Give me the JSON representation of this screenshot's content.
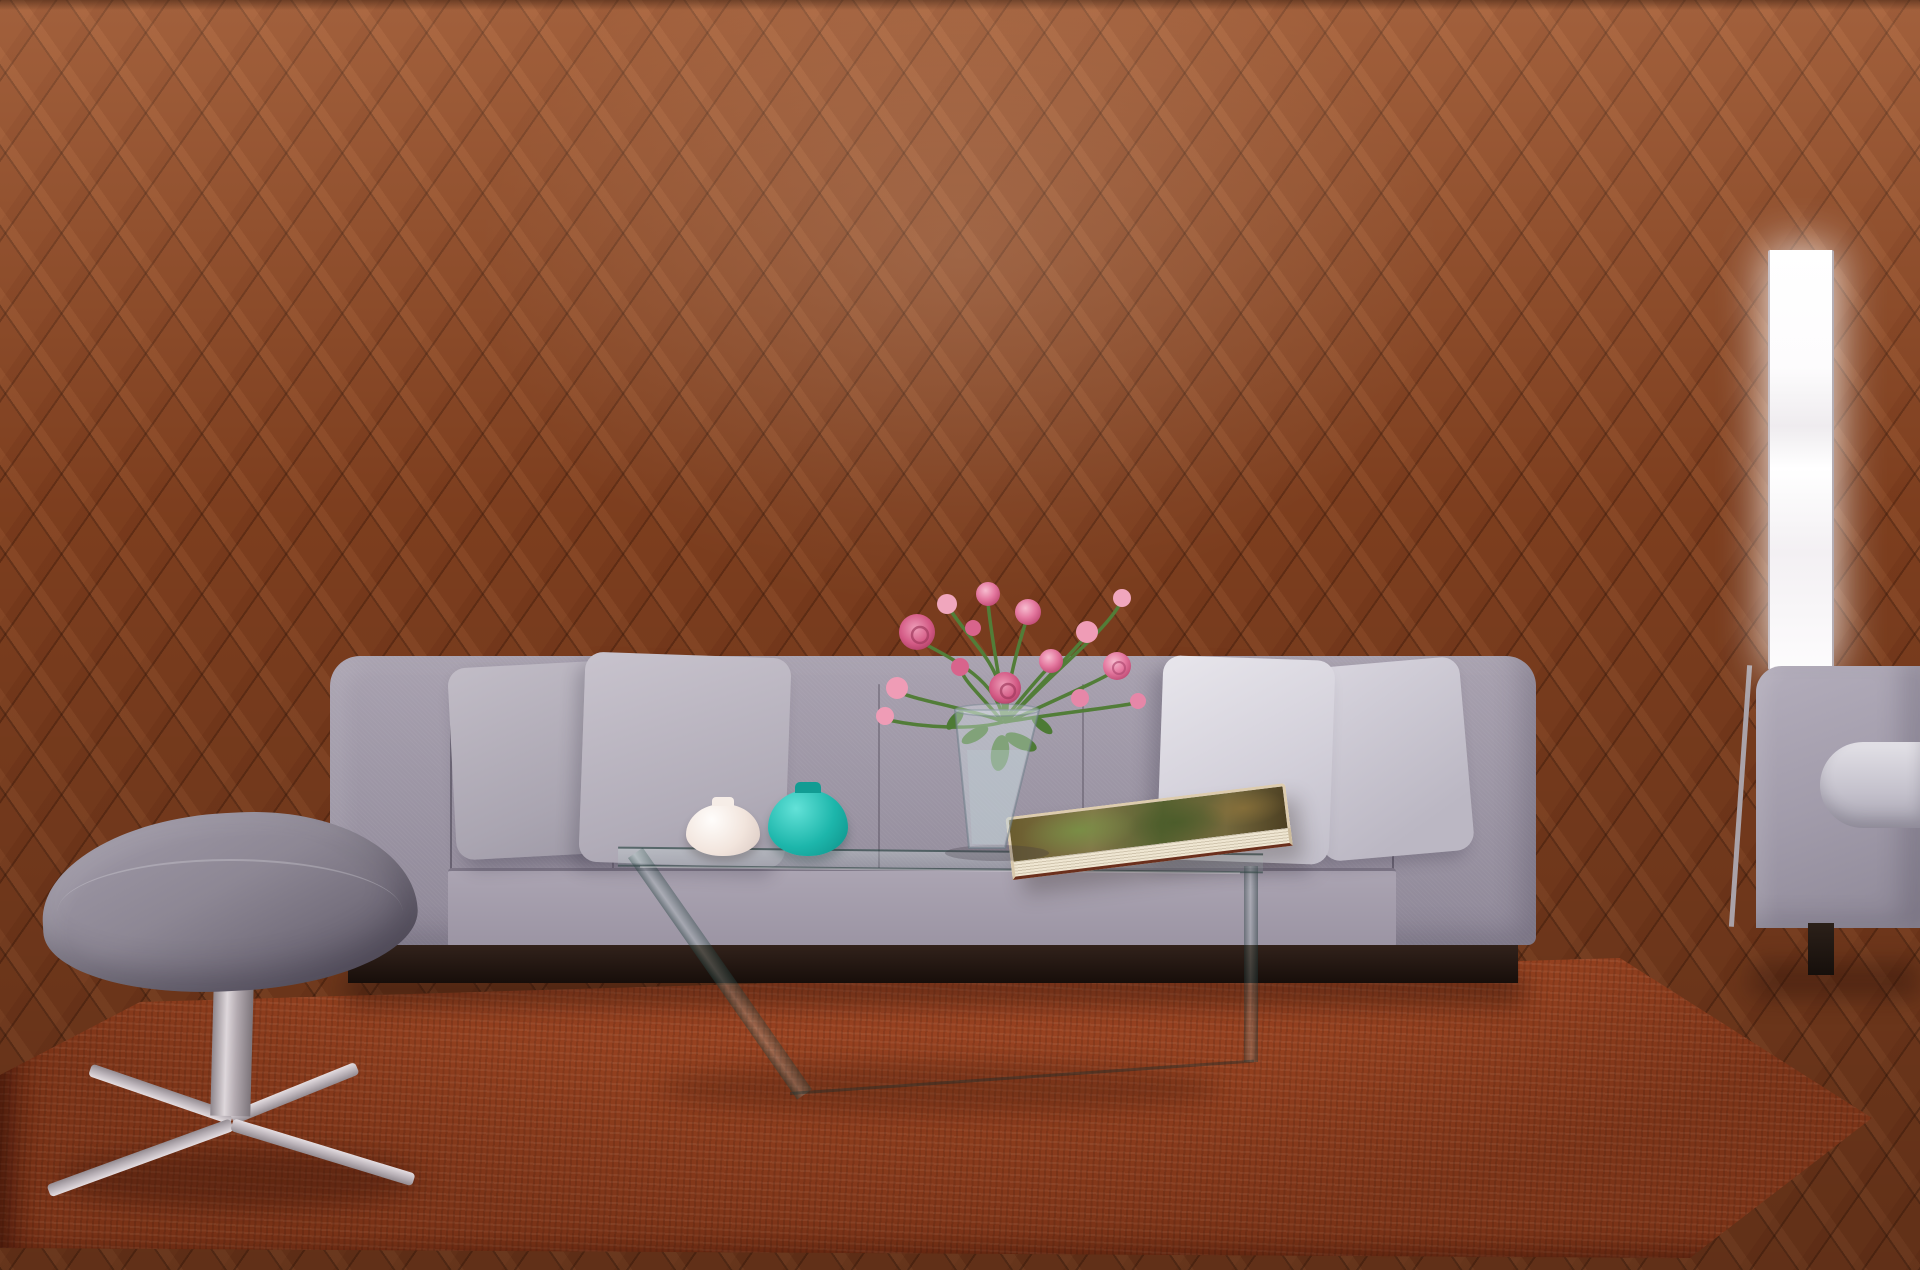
{
  "scene": {
    "name": "Living room poster size comparison mockup",
    "colors": {
      "frame_border": "#2e2d31",
      "label_text": "#17161a",
      "wall": "#efe9ec",
      "sofa_fabric": "#9b94a3",
      "rug": "#ab4b28",
      "floor_wood": "#8b4522",
      "teal_vase": "#1cb5aa",
      "flower_pink": "#e4789f"
    }
  },
  "frames": [
    {
      "id": "150x100",
      "label": "150 x 100 cm",
      "width_cm": 150,
      "height_cm": 100
    },
    {
      "id": "90x60",
      "label": "90 x 60 cm",
      "width_cm": 90,
      "height_cm": 60
    },
    {
      "id": "20x30",
      "label": "20 x 30 cm",
      "width_cm": 20,
      "height_cm": 30
    },
    {
      "id": "din-a4",
      "label_line1": "DIN A4",
      "label_line2": "29,7 x 21 cm",
      "width_cm": 21,
      "height_cm": 29.7
    },
    {
      "id": "60x40",
      "label": "60 x 40 cm",
      "width_cm": 40,
      "height_cm": 60
    }
  ]
}
